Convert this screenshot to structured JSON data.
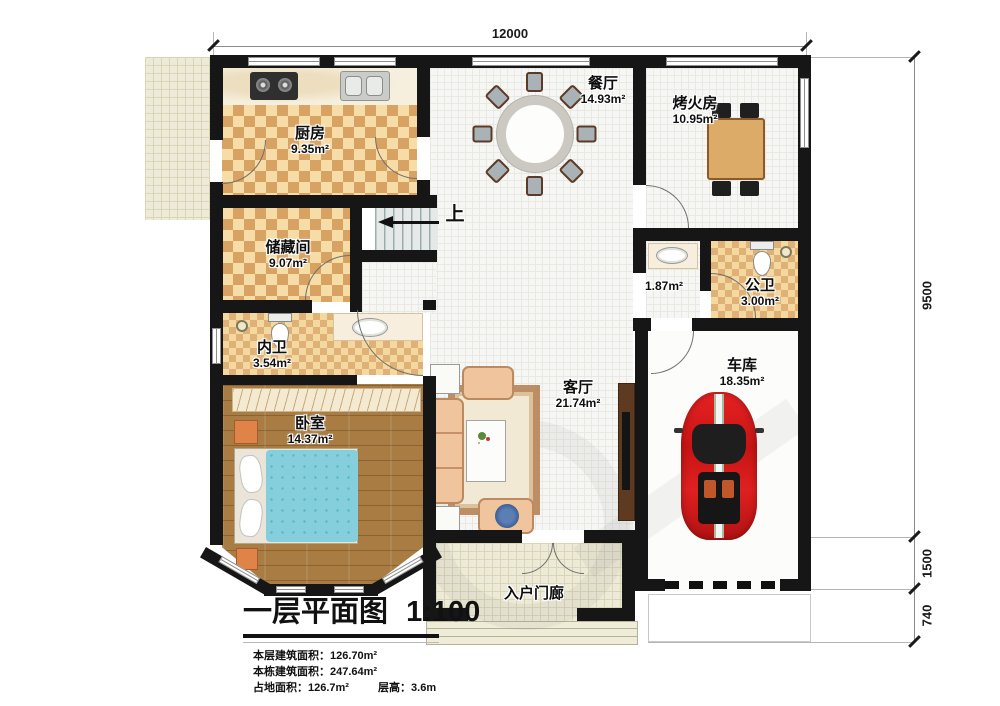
{
  "title": {
    "text": "一层平面图",
    "scale": "1:100"
  },
  "stats": {
    "line1": "本层建筑面积：126.70m²",
    "line2": "本栋建筑面积：247.64m²",
    "line3a": "占地面积：126.7m²",
    "line3b": "层高：3.6m"
  },
  "dimensions": {
    "width_top": "12000",
    "height_main": "9500",
    "height_garage": "1500",
    "height_apron": "740"
  },
  "rooms": {
    "kitchen": {
      "name": "厨房",
      "area": "9.35m²"
    },
    "dining": {
      "name": "餐厅",
      "area": "14.93m²"
    },
    "fire_room": {
      "name": "烤火房",
      "area": "10.95m²"
    },
    "storage": {
      "name": "储藏间",
      "area": "9.07m²"
    },
    "hallway": {
      "area": "1.87m²"
    },
    "public_bath": {
      "name": "公卫",
      "area": "3.00m²"
    },
    "inner_bath": {
      "name": "内卫",
      "area": "3.54m²"
    },
    "bedroom": {
      "name": "卧室",
      "area": "14.37m²"
    },
    "living": {
      "name": "客厅",
      "area": "21.74m²"
    },
    "garage": {
      "name": "车库",
      "area": "18.35m²"
    },
    "porch": {
      "name": "入户门廊"
    }
  },
  "stairs": {
    "direction": "上"
  }
}
